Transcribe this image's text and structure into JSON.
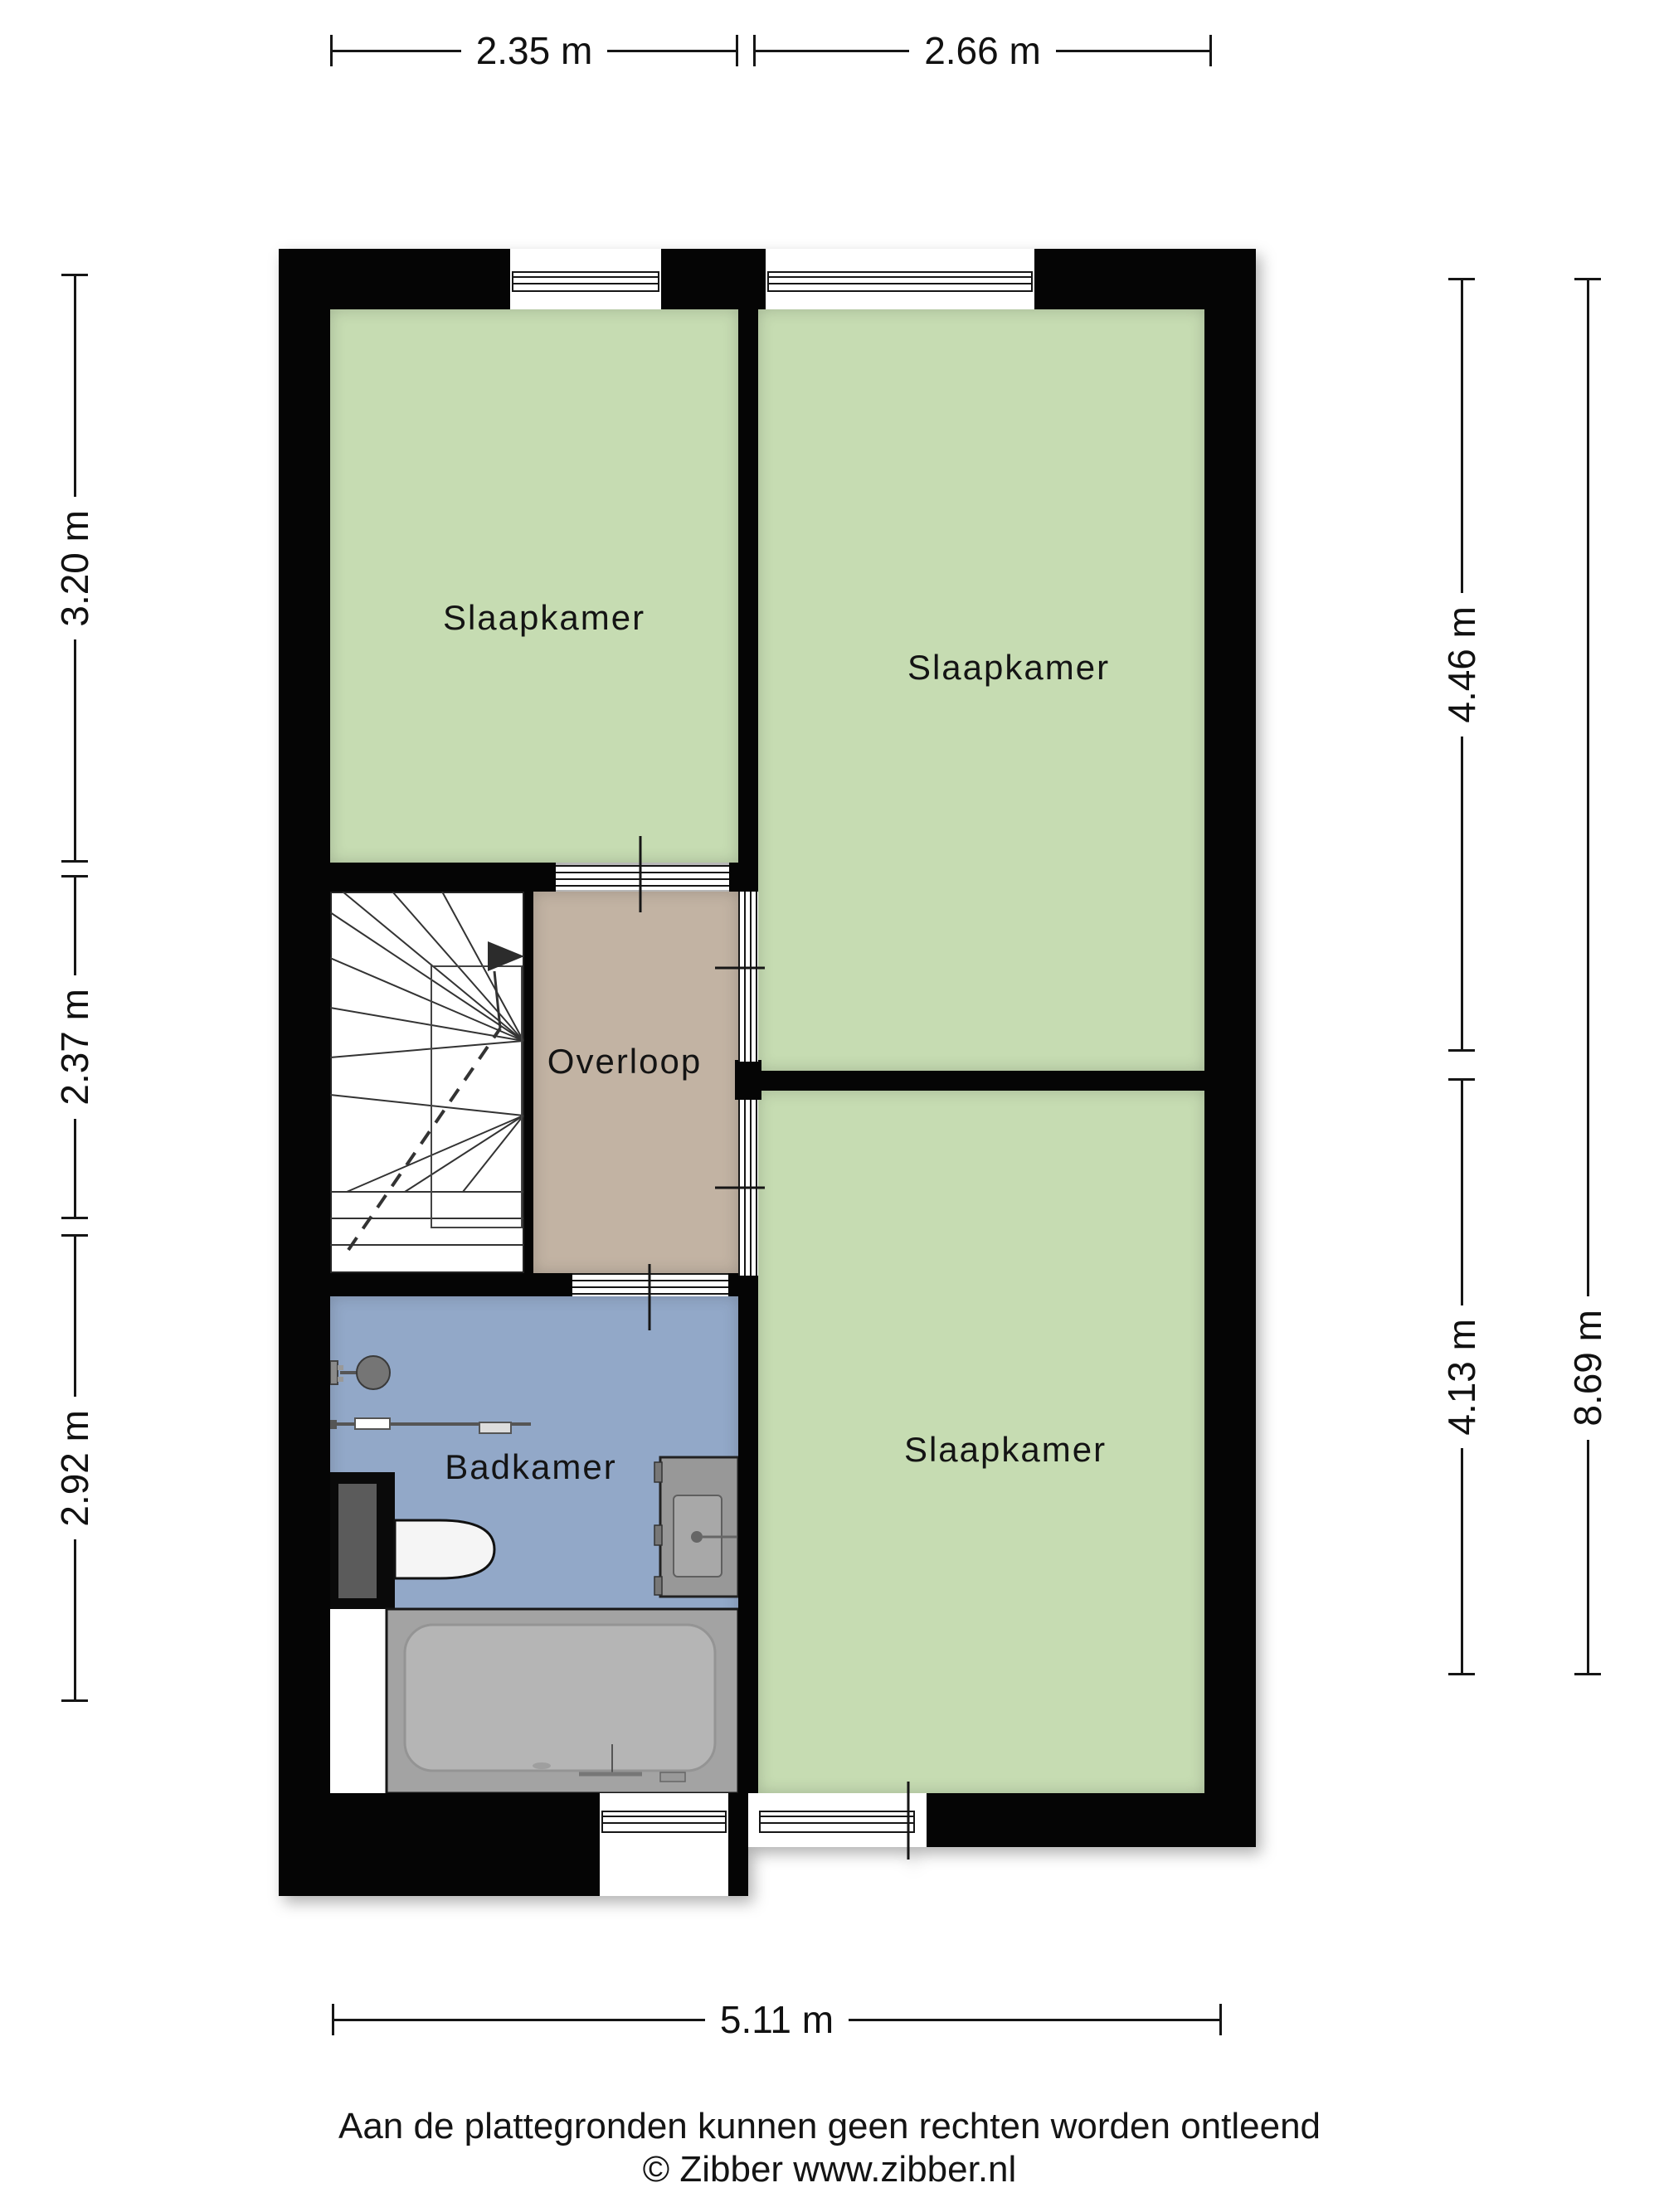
{
  "plan": {
    "rooms": {
      "bedroom_top_left": {
        "label": "Slaapkamer"
      },
      "bedroom_top_right": {
        "label": "Slaapkamer"
      },
      "bedroom_bottom_right": {
        "label": "Slaapkamer"
      },
      "landing": {
        "label": "Overloop"
      },
      "bathroom": {
        "label": "Badkamer"
      }
    },
    "colors": {
      "bedroom_fill": "#c6dcb2",
      "landing_fill": "#c2b3a3",
      "bathroom_fill": "#92a8c8",
      "wall": "#050505",
      "fixture_gray": "#a3a3a3"
    }
  },
  "dimensions": {
    "top": [
      {
        "label": "2.35 m"
      },
      {
        "label": "2.66 m"
      }
    ],
    "left": [
      {
        "label": "3.20 m"
      },
      {
        "label": "2.37 m"
      },
      {
        "label": "2.92 m"
      }
    ],
    "right": [
      {
        "label": "4.46 m"
      },
      {
        "label": "4.13 m"
      }
    ],
    "right_total": {
      "label": "8.69 m"
    },
    "bottom": {
      "label": "5.11 m"
    }
  },
  "footer": {
    "disclaimer": "Aan de plattegronden kunnen geen rechten worden ontleend",
    "copyright": "© Zibber www.zibber.nl"
  }
}
